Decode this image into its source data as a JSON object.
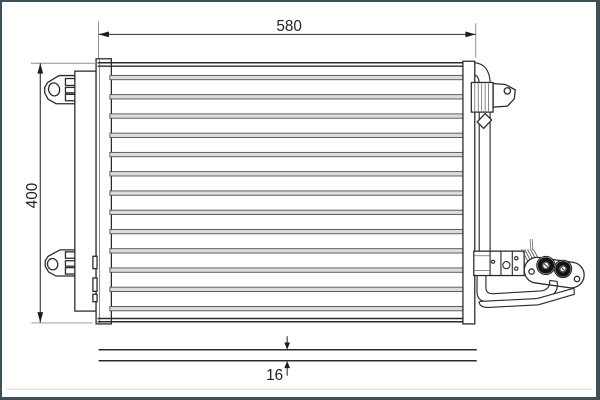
{
  "drawing": {
    "dimensions": {
      "width_label": "580",
      "height_label": "400",
      "thickness_label": "16"
    },
    "core": {
      "tube_rows": 13
    },
    "colors": {
      "line": "#2b2b2b",
      "dim_line": "#2e2e2e",
      "extension_line": "#8f8f8f",
      "tube_fill": "#dcdcdc",
      "tube_stroke": "#4f4f4f",
      "port_ring": "#141414",
      "frame": "#3e4f58",
      "frame_faint_line": "#cdd3d5",
      "background": "#ffffff",
      "text": "#222222"
    }
  }
}
